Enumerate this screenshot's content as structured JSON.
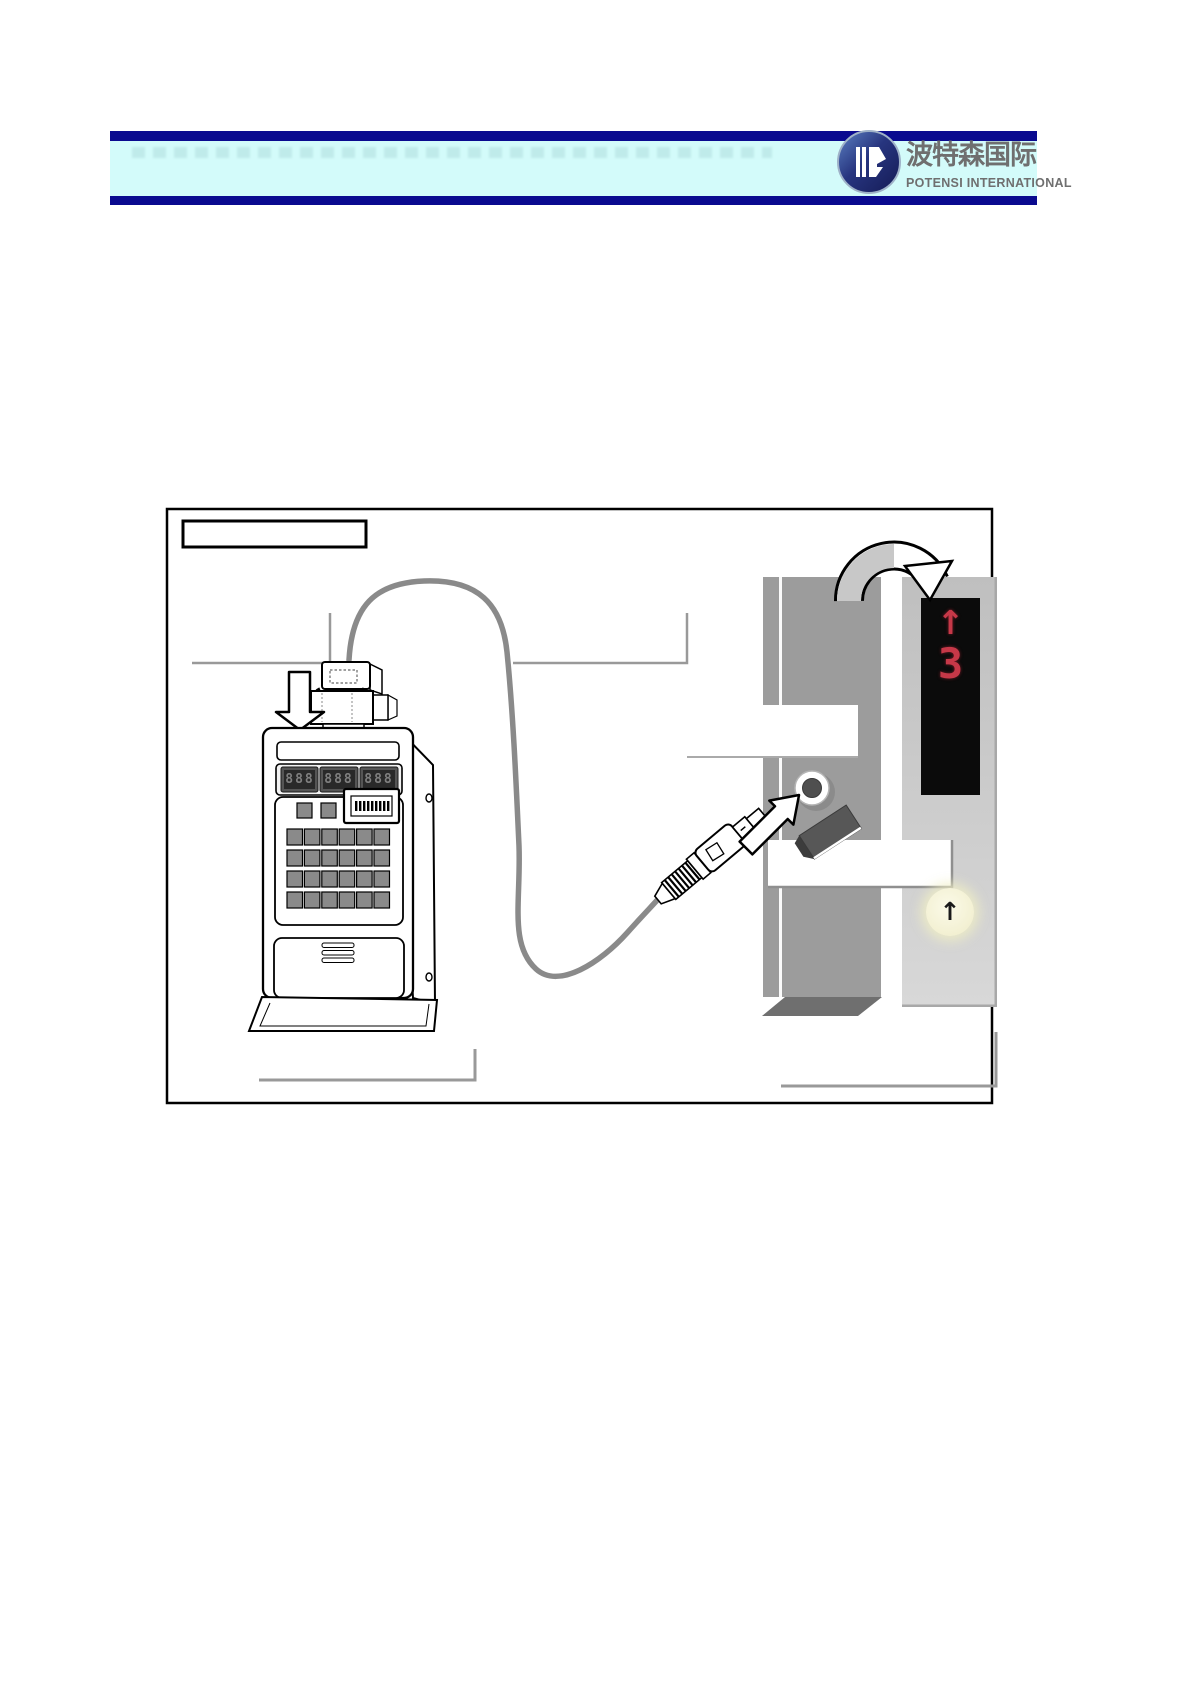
{
  "header": {
    "brand_cn": "波特森国际",
    "brand_en": "POTENSI INTERNATIONAL",
    "bar_color": "#0a0a8f",
    "band_color": "#d3fbfa",
    "text_color": "#6f6f6f",
    "logo_colors": {
      "disc_dark": "#1b2a6b",
      "disc_light": "#4a6fb5",
      "glyph": "#ffffff"
    }
  },
  "figure": {
    "caption_box_text": "",
    "callout_box_1_text": "",
    "callout_box_2_text": "",
    "service_tool": {
      "display_modules": [
        "888",
        "888",
        "888"
      ]
    },
    "hall_indicator": {
      "direction_glyph": "↑",
      "floor": "3",
      "dot_color": "#c63848",
      "panel_bg": "#0b0b0b"
    },
    "hall_button": {
      "glyph": "↑",
      "bg": "#f5f3d7"
    },
    "colors": {
      "door_jamb": "#9c9c9c",
      "jamb_bottom": "#6f6f6f",
      "hall_panel": "#c9c9c9",
      "cable": "#8a8a8a",
      "callout_line": "#999999",
      "cover_block": "#575757"
    }
  }
}
